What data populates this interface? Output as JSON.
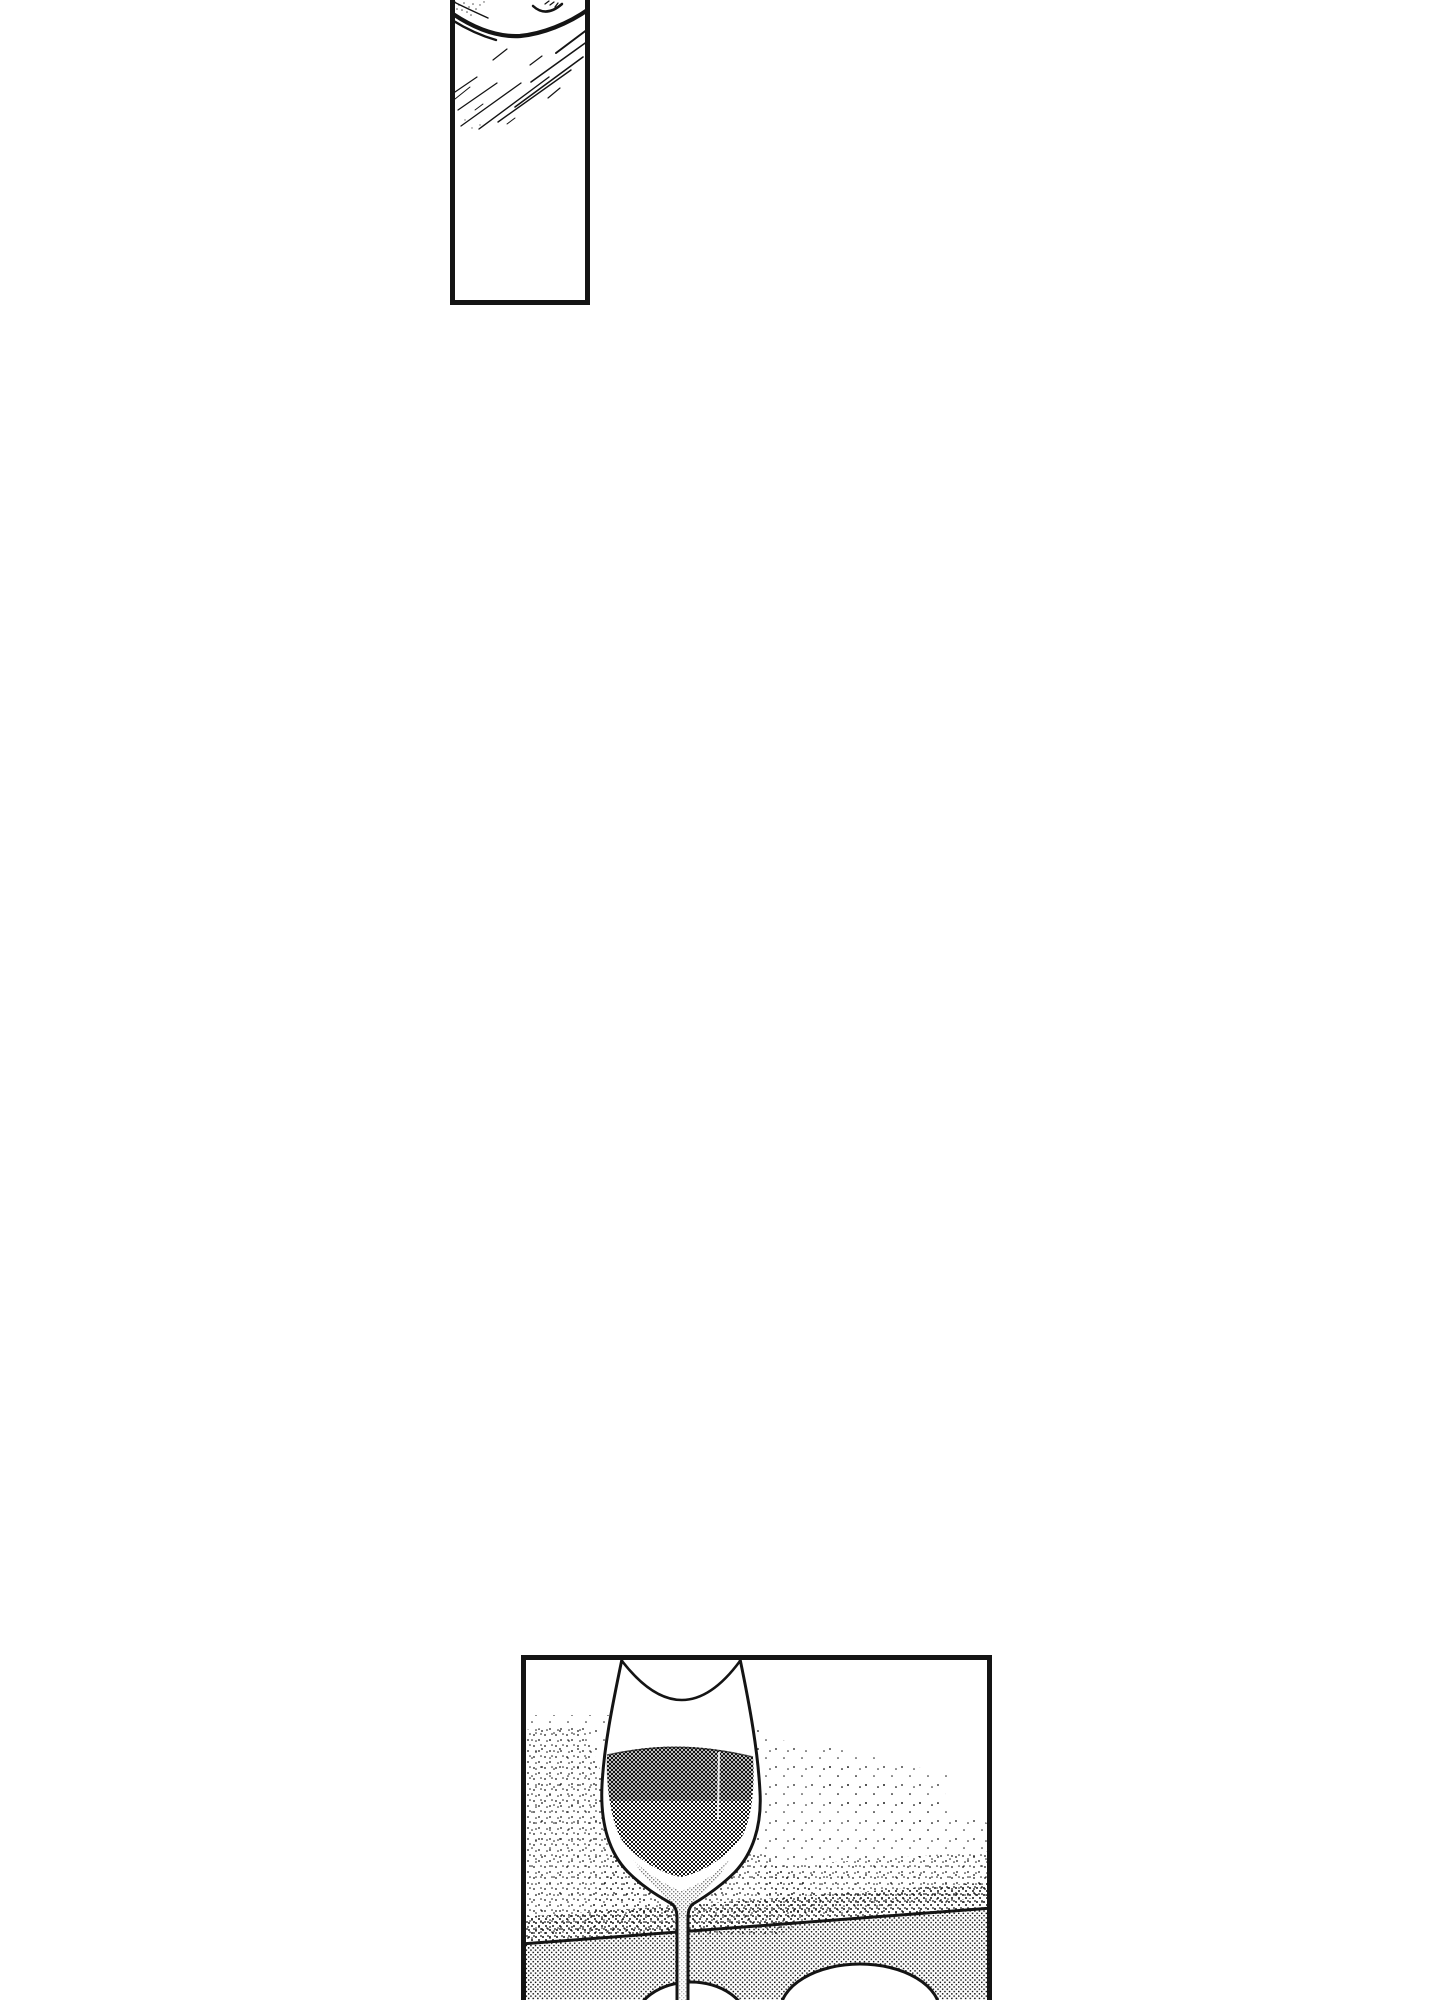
{
  "page": {
    "kind": "manga-page",
    "colors": {
      "paper": "#ffffff",
      "ink": "#141414"
    }
  },
  "panels": [
    {
      "id": "panel-face",
      "alt": "Tall narrow manga panel, cut off at the top of the page: close-up fragment of a face with a closed eye, a sweeping cheek line and diagonal hatching; lower two thirds empty white"
    },
    {
      "id": "panel-wine",
      "alt": "Manga panel cut off at the bottom of the page: a stemmed glass of red wine standing on a table, halftone shading, a diagonal table edge line and two round white dishes behind the stem"
    }
  ]
}
